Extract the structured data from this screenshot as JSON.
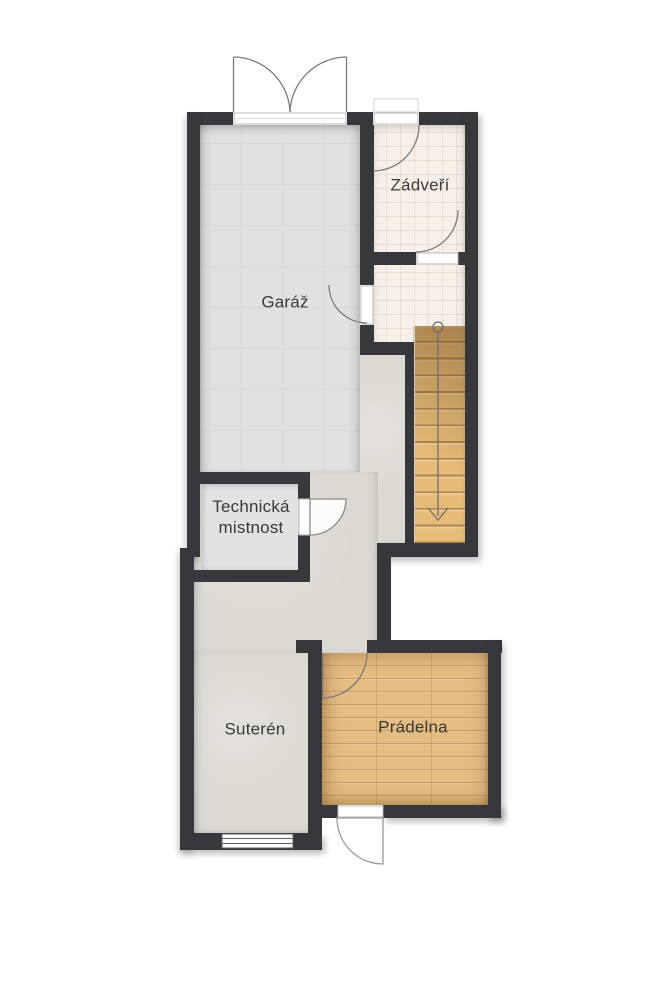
{
  "plan_type": "floor-plan",
  "rooms": {
    "garaz": {
      "label": "Garáž"
    },
    "zadveri": {
      "label": "Zádveří"
    },
    "technicka": {
      "line1": "Technická",
      "line2": "mistnost"
    },
    "suteren": {
      "label": "Suterén"
    },
    "pradelna": {
      "label": "Prádelna"
    }
  },
  "stairs": {
    "treads": 13,
    "direction": "down",
    "marker": "circle-start-arrow-end"
  },
  "features": {
    "window": "suteren-bottom-wall",
    "doors": [
      "garage-double-door-top",
      "entrance-door",
      "zadveri-inner-door",
      "garage-side-door",
      "technicka-door",
      "pradelna-inner-door",
      "pradelna-exterior-door"
    ]
  },
  "colors": {
    "wall": "#36383c",
    "garage": "#e1e1e3",
    "tile": "#f7f0e8",
    "suteren": "#dcd8d2",
    "tech": "#e3e2e3",
    "wood": "#e5bd83",
    "stairwood": "#e7bb78",
    "label": "#3a3a3a",
    "bg": "#ffffff"
  }
}
